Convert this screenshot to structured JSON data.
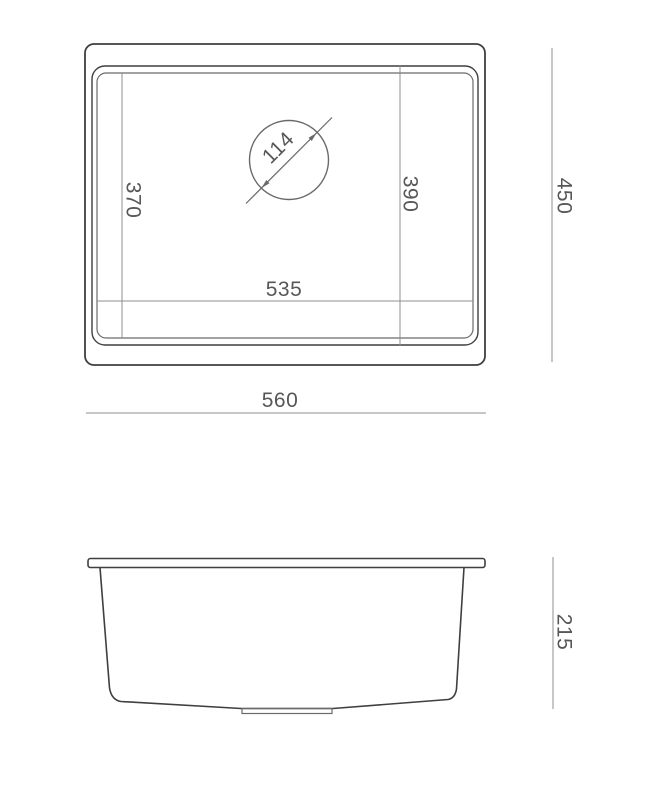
{
  "colors": {
    "background": "#ffffff",
    "outline": "#3f3f3f",
    "outline_soft": "#6a6a6a",
    "dim_line": "#8f8f8f",
    "dim_text": "#575757"
  },
  "top_view": {
    "bowl_depth_inner": "370",
    "drain_diameter": "114",
    "bowl_depth_outer": "390",
    "bowl_width": "535",
    "overall_width": "560",
    "overall_depth": "450"
  },
  "side_view": {
    "overall_height": "215"
  }
}
